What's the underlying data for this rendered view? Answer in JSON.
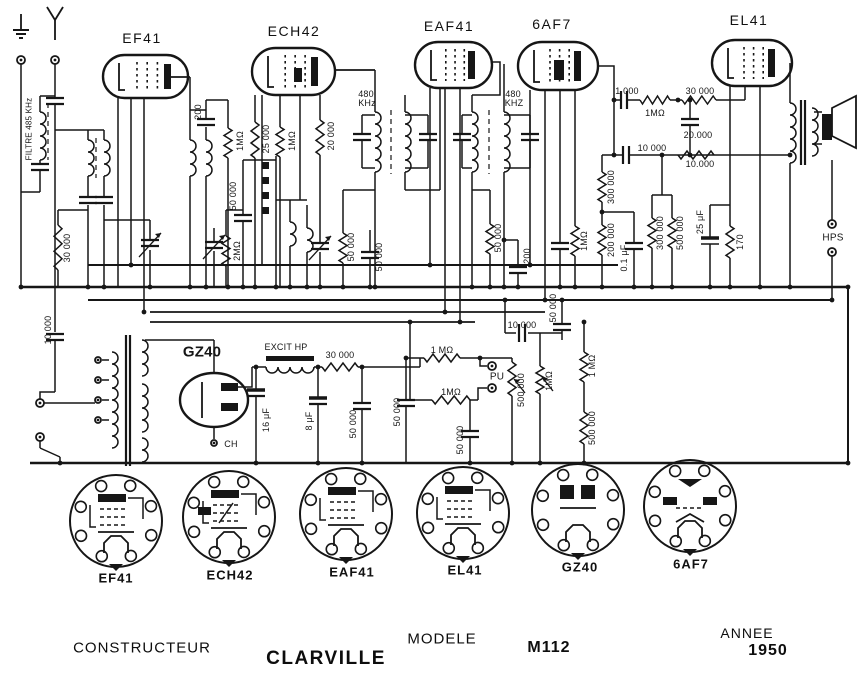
{
  "colors": {
    "ink": "#161616",
    "paper": "#ffffff"
  },
  "tubes": [
    {
      "label": "EF41",
      "x": 142,
      "y": 38
    },
    {
      "label": "ECH42",
      "x": 294,
      "y": 31
    },
    {
      "label": "EAF41",
      "x": 449,
      "y": 26
    },
    {
      "label": "6AF7",
      "x": 552,
      "y": 24
    },
    {
      "label": "EL41",
      "x": 749,
      "y": 20
    }
  ],
  "sockets": [
    {
      "label": "EF41",
      "x": 116,
      "y": 578,
      "cx": 116,
      "cy": 521,
      "type": "p"
    },
    {
      "label": "ECH42",
      "x": 230,
      "y": 575,
      "cx": 229,
      "cy": 517,
      "type": "h"
    },
    {
      "label": "EAF41",
      "x": 352,
      "y": 572,
      "cx": 346,
      "cy": 514,
      "type": "p"
    },
    {
      "label": "EL41",
      "x": 465,
      "y": 570,
      "cx": 463,
      "cy": 513,
      "type": "p"
    },
    {
      "label": "GZ40",
      "x": 580,
      "y": 567,
      "cx": 578,
      "cy": 510,
      "type": "g"
    },
    {
      "label": "6AF7",
      "x": 691,
      "y": 564,
      "cx": 690,
      "cy": 506,
      "type": "t"
    }
  ],
  "labels": [
    {
      "t": "FILTRE 485 KHz",
      "x": 29,
      "y": 129,
      "v": 1,
      "s": 8
    },
    {
      "t": "30 000",
      "x": 67,
      "y": 248,
      "v": 1
    },
    {
      "t": "10 000",
      "x": 48,
      "y": 330,
      "v": 1
    },
    {
      "t": "200",
      "x": 198,
      "y": 112,
      "v": 1
    },
    {
      "t": "1MΩ",
      "x": 240,
      "y": 141,
      "v": 1
    },
    {
      "t": "25 000",
      "x": 266,
      "y": 139,
      "v": 1
    },
    {
      "t": "1MΩ",
      "x": 292,
      "y": 141,
      "v": 1
    },
    {
      "t": "20 000",
      "x": 331,
      "y": 136,
      "v": 1
    },
    {
      "t": "50 000",
      "x": 233,
      "y": 196,
      "v": 1
    },
    {
      "t": "2MΩ",
      "x": 237,
      "y": 251,
      "v": 1
    },
    {
      "t": "50 000",
      "x": 351,
      "y": 247,
      "v": 1
    },
    {
      "t": "50 000",
      "x": 379,
      "y": 257,
      "v": 1
    },
    {
      "t": "480",
      "x": 366,
      "y": 94
    },
    {
      "t": "KHz",
      "x": 367,
      "y": 103
    },
    {
      "t": "480",
      "x": 513,
      "y": 94
    },
    {
      "t": "KHZ",
      "x": 514,
      "y": 103
    },
    {
      "t": "50 000",
      "x": 498,
      "y": 238,
      "v": 1
    },
    {
      "t": "200",
      "x": 527,
      "y": 256,
      "v": 1
    },
    {
      "t": "1MΩ",
      "x": 584,
      "y": 241,
      "v": 1
    },
    {
      "t": "300 000",
      "x": 611,
      "y": 187,
      "v": 1
    },
    {
      "t": "200 000",
      "x": 611,
      "y": 240,
      "v": 1
    },
    {
      "t": "0.1 μF",
      "x": 624,
      "y": 258,
      "v": 1
    },
    {
      "t": "300 000",
      "x": 660,
      "y": 233,
      "v": 1
    },
    {
      "t": "500 000",
      "x": 680,
      "y": 233,
      "v": 1
    },
    {
      "t": "25 μF",
      "x": 700,
      "y": 222,
      "v": 1
    },
    {
      "t": "170",
      "x": 740,
      "y": 242,
      "v": 1
    },
    {
      "t": "1 000",
      "x": 627,
      "y": 91
    },
    {
      "t": "1MΩ",
      "x": 655,
      "y": 113
    },
    {
      "t": "30 000",
      "x": 700,
      "y": 91
    },
    {
      "t": "20.000",
      "x": 698,
      "y": 135
    },
    {
      "t": "10 000",
      "x": 652,
      "y": 148
    },
    {
      "t": "10.000",
      "x": 700,
      "y": 164
    },
    {
      "t": "HPS",
      "x": 833,
      "y": 238,
      "s": 10
    },
    {
      "t": "GZ40",
      "x": 202,
      "y": 352,
      "s": 15,
      "b": 1
    },
    {
      "t": "EXCIT HP",
      "x": 286,
      "y": 347
    },
    {
      "t": "30 000",
      "x": 340,
      "y": 355
    },
    {
      "t": "CH",
      "x": 231,
      "y": 444
    },
    {
      "t": "16 μF",
      "x": 266,
      "y": 420,
      "v": 1
    },
    {
      "t": "8 μF",
      "x": 309,
      "y": 421,
      "v": 1
    },
    {
      "t": "50 000",
      "x": 353,
      "y": 424,
      "v": 1
    },
    {
      "t": "50 000",
      "x": 397,
      "y": 412,
      "v": 1
    },
    {
      "t": "1 MΩ",
      "x": 442,
      "y": 350
    },
    {
      "t": "1MΩ",
      "x": 451,
      "y": 392
    },
    {
      "t": "PU",
      "x": 497,
      "y": 377,
      "s": 10
    },
    {
      "t": "50 000",
      "x": 460,
      "y": 440,
      "v": 1
    },
    {
      "t": "500.000",
      "x": 521,
      "y": 390,
      "v": 1
    },
    {
      "t": "1MΩ",
      "x": 549,
      "y": 381,
      "v": 1
    },
    {
      "t": "10.000",
      "x": 522,
      "y": 325
    },
    {
      "t": "50 000",
      "x": 553,
      "y": 308,
      "v": 1
    },
    {
      "t": "1 MΩ",
      "x": 592,
      "y": 366,
      "v": 1
    },
    {
      "t": "500 000",
      "x": 592,
      "y": 428,
      "v": 1
    }
  ],
  "footer": {
    "constructeur_label": "CONSTRUCTEUR",
    "brand": "CLARVILLE",
    "modele_label": "MODELE",
    "model": "M112",
    "annee_label": "ANNEE",
    "year": "1950"
  }
}
